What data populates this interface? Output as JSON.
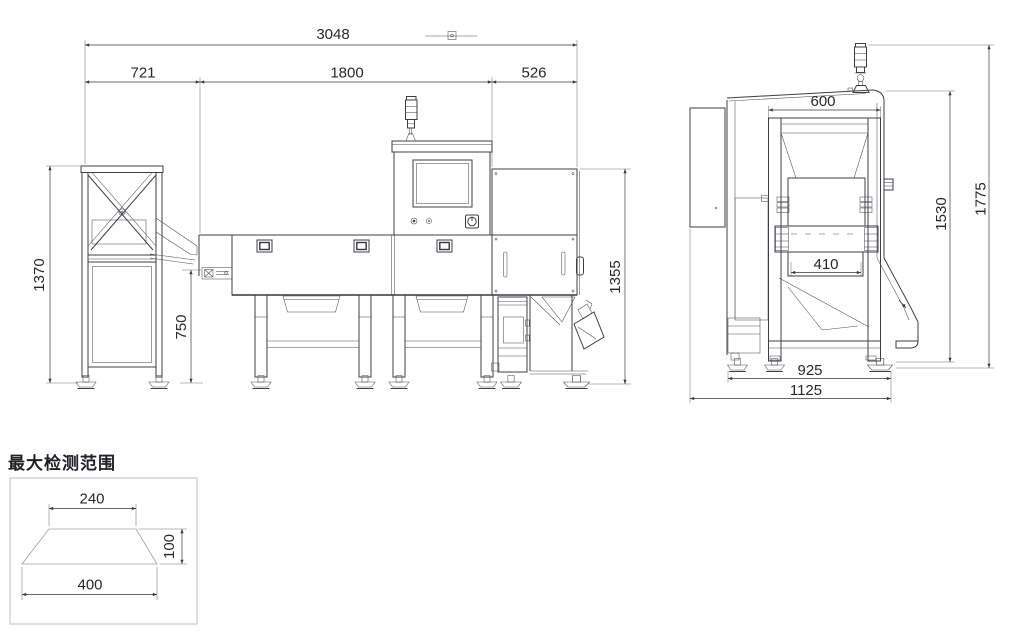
{
  "drawing": {
    "background": "#ffffff",
    "line_color": "#3b3f45",
    "dim_color": "#26292c",
    "front_dims": {
      "overall_length": "3048",
      "infeed_length": "721",
      "body_length": "1800",
      "outfeed_length": "526",
      "stand_height": "1370",
      "belt_height": "750",
      "body_height": "1355"
    },
    "side_dims": {
      "top_frame_width": "600",
      "belt_width": "410",
      "foot_span": "925",
      "overall_depth": "1125",
      "frame_height": "1530",
      "overall_height": "1775"
    },
    "detection_range": {
      "title": "最大检测范围",
      "top_width": "240",
      "height": "100",
      "bottom_width": "400"
    }
  }
}
